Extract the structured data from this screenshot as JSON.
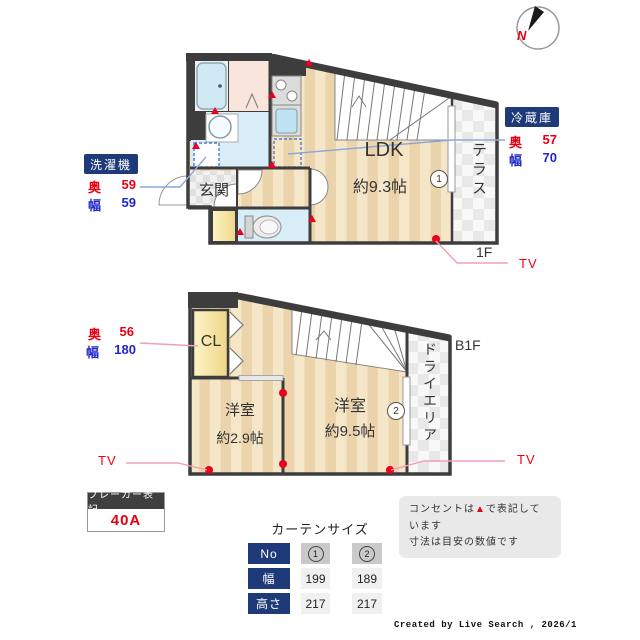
{
  "compass": {
    "north": "N"
  },
  "floor1": {
    "label": "1F",
    "ldk": "LDK",
    "ldk_size": "約9.3帖",
    "genkan": "玄関",
    "terrace": "テラス",
    "window_no": "1",
    "tv": "TV"
  },
  "floorb1": {
    "label": "B1F",
    "cl": "CL",
    "room_small": "洋室",
    "room_small_size": "約2.9帖",
    "room_large": "洋室",
    "room_large_size": "約9.5帖",
    "dry_area": "ドライエリア",
    "window_no": "2",
    "tv_left": "TV",
    "tv_right": "TV"
  },
  "appliances": {
    "washer": {
      "title": "洗濯機",
      "depth_label": "奥",
      "depth": "59",
      "width_label": "幅",
      "width": "59"
    },
    "fridge": {
      "title": "冷蔵庫",
      "depth_label": "奥",
      "depth": "57",
      "width_label": "幅",
      "width": "70"
    },
    "closet": {
      "depth_label": "奥",
      "depth": "56",
      "width_label": "幅",
      "width": "180"
    }
  },
  "breaker": {
    "title": "ブレーカー表記",
    "value": "40A"
  },
  "notes": {
    "line1_pre": "コンセントは",
    "line1_marker": "▲",
    "line1_post": "で表記しています",
    "line2": "寸法は目安の数値です"
  },
  "curtain_table": {
    "title": "カーテンサイズ",
    "no_label": "No",
    "width_label": "幅",
    "height_label": "高さ",
    "col1": {
      "no": "1",
      "width": "199",
      "height": "217"
    },
    "col2": {
      "no": "2",
      "width": "189",
      "height": "217"
    }
  },
  "footer": "Created by Live Search , 2026/1",
  "colors": {
    "accent_navy": "#1e3a78",
    "red": "#e60012",
    "blue": "#1f25c8",
    "wall": "#3d3d3d",
    "tv_line": "#f2a0b4",
    "pointer_line": "#8aa8d8"
  }
}
